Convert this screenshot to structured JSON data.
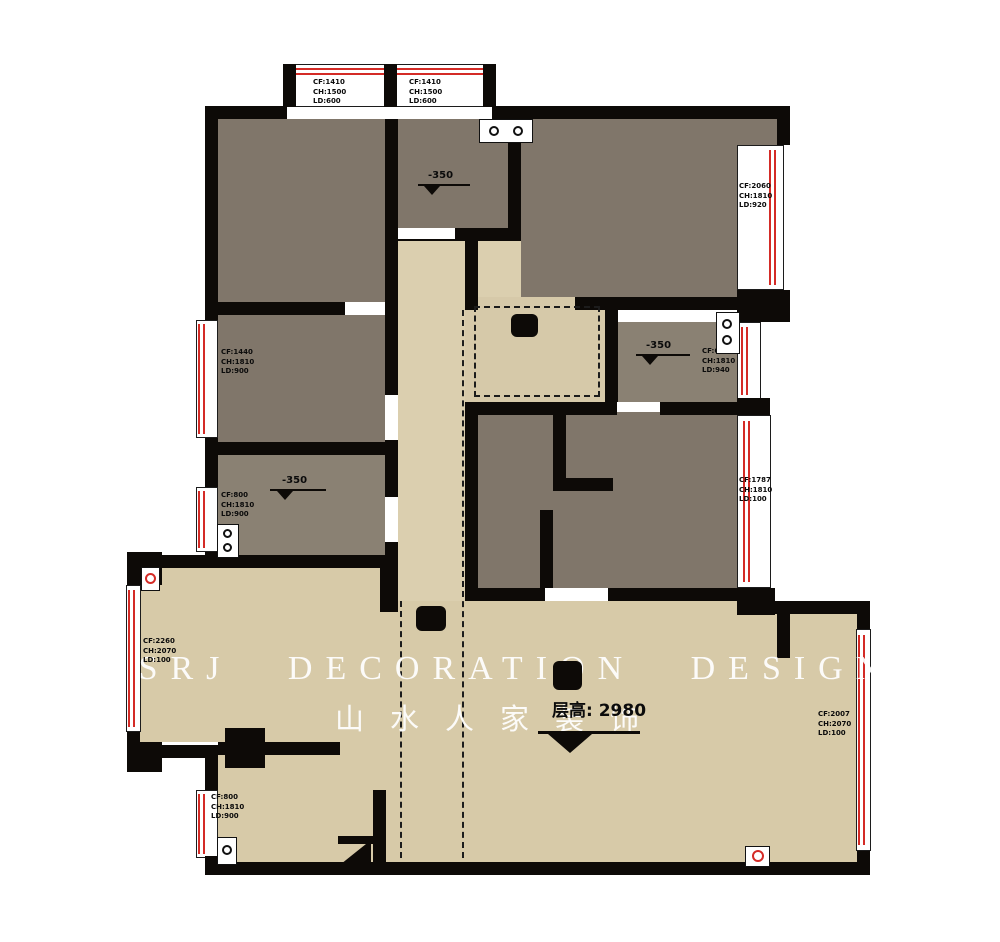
{
  "watermark": {
    "line1": "SSRJ DECORATION DESIGN",
    "line2": "山水人家装饰"
  },
  "floor_height": {
    "label": "层高: 2980"
  },
  "levels": [
    {
      "label": "-350"
    },
    {
      "label": "-350"
    },
    {
      "label": "-350"
    }
  ],
  "windows": [
    {
      "name": "top-bay-window-1",
      "l1": "CF:1410",
      "l2": "CH:1500",
      "l3": "LD:600"
    },
    {
      "name": "top-bay-window-2",
      "l1": "CF:1410",
      "l2": "CH:1500",
      "l3": "LD:600"
    },
    {
      "name": "right-top-window",
      "l1": "CF:2060",
      "l2": "CH:1810",
      "l3": "LD:920"
    },
    {
      "name": "left-middle-window",
      "l1": "CF:1440",
      "l2": "CH:1810",
      "l3": "LD:900"
    },
    {
      "name": "bathroom-window",
      "l1": "CF:600",
      "l2": "CH:1810",
      "l3": "LD:940"
    },
    {
      "name": "left-lower-window",
      "l1": "CF:800",
      "l2": "CH:1810",
      "l3": "LD:900"
    },
    {
      "name": "left-living-window",
      "l1": "CF:2260",
      "l2": "CH:2070",
      "l3": "LD:100"
    },
    {
      "name": "right-middle-window",
      "l1": "CF:1787",
      "l2": "CH:1810",
      "l3": "LD:100"
    },
    {
      "name": "right-living-window",
      "l1": "CF:2007",
      "l2": "CH:2070",
      "l3": "LD:100"
    },
    {
      "name": "bottom-left-window",
      "l1": "CF:800",
      "l2": "CH:1810",
      "l3": "LD:900"
    }
  ],
  "icons": {
    "level-marker-icon": "filled triangle on datum line",
    "sink-double-icon": "two circles in white box",
    "drain-icon": "circle in white box",
    "sprinkler-icon": "red circle in white box",
    "door-leaf-icon": "black triangle"
  },
  "colors": {
    "wall": "#0d0a07",
    "room_dark": "#80766a",
    "room_dark_light": "#8a8173",
    "corridor_beige": "#dbcfaf",
    "living_beige": "#d7caa8",
    "window_red": "#d42b26",
    "watermark": "#ffffff"
  }
}
